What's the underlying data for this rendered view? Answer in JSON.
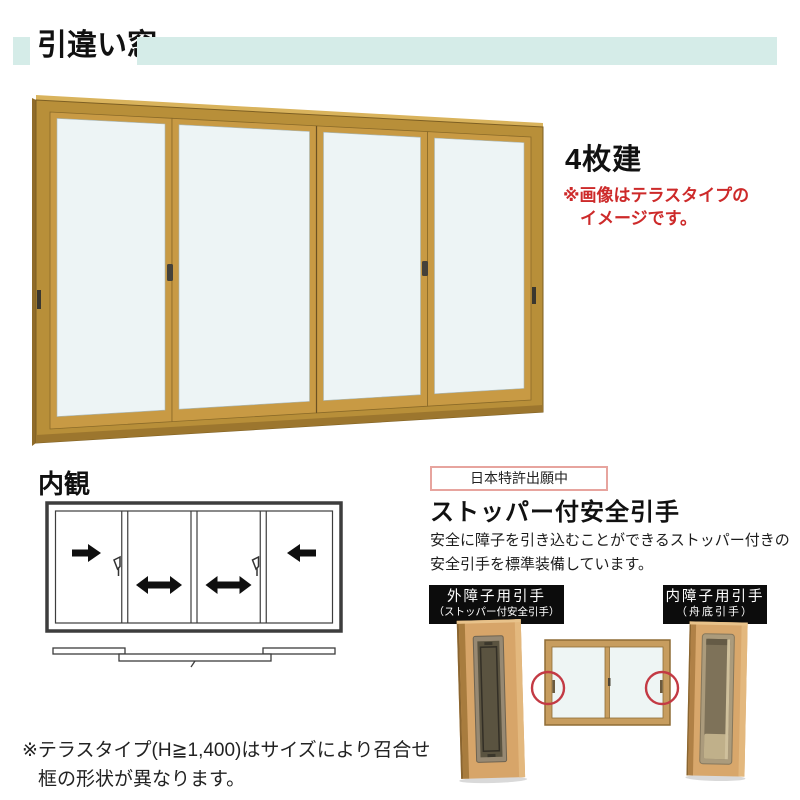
{
  "header": {
    "title": "引違い窓",
    "accent_color": "#d5ece8"
  },
  "main_product": {
    "panel_label": "4枚建",
    "note_line1": "※画像はテラスタイプの",
    "note_line2": "イメージです。",
    "note_color": "#cd2a2a",
    "frame_color": "#c0923c",
    "glass_color": "#edf4f5"
  },
  "interior_view": {
    "title": "内観",
    "slide_directions": [
      "right",
      "both",
      "both",
      "left"
    ]
  },
  "feature": {
    "patent_badge": "日本特許出願中",
    "heading": "ストッパー付安全引手",
    "body_line1": "安全に障子を引き込むことができるストッパー付きの",
    "body_line2": "安全引手を標準装備しています。",
    "outer_label_line1": "外障子用引手",
    "outer_label_line2": "（ストッパー付安全引手）",
    "inner_label_line1": "内障子用引手",
    "inner_label_line2": "（舟底引手）",
    "label_bg": "#0c0c0c",
    "highlight_circle_color": "#c33a44"
  },
  "footer_note": {
    "line1": "※テラスタイプ(H≧1,400)はサイズにより召合せ",
    "line2": "框の形状が異なります。"
  }
}
